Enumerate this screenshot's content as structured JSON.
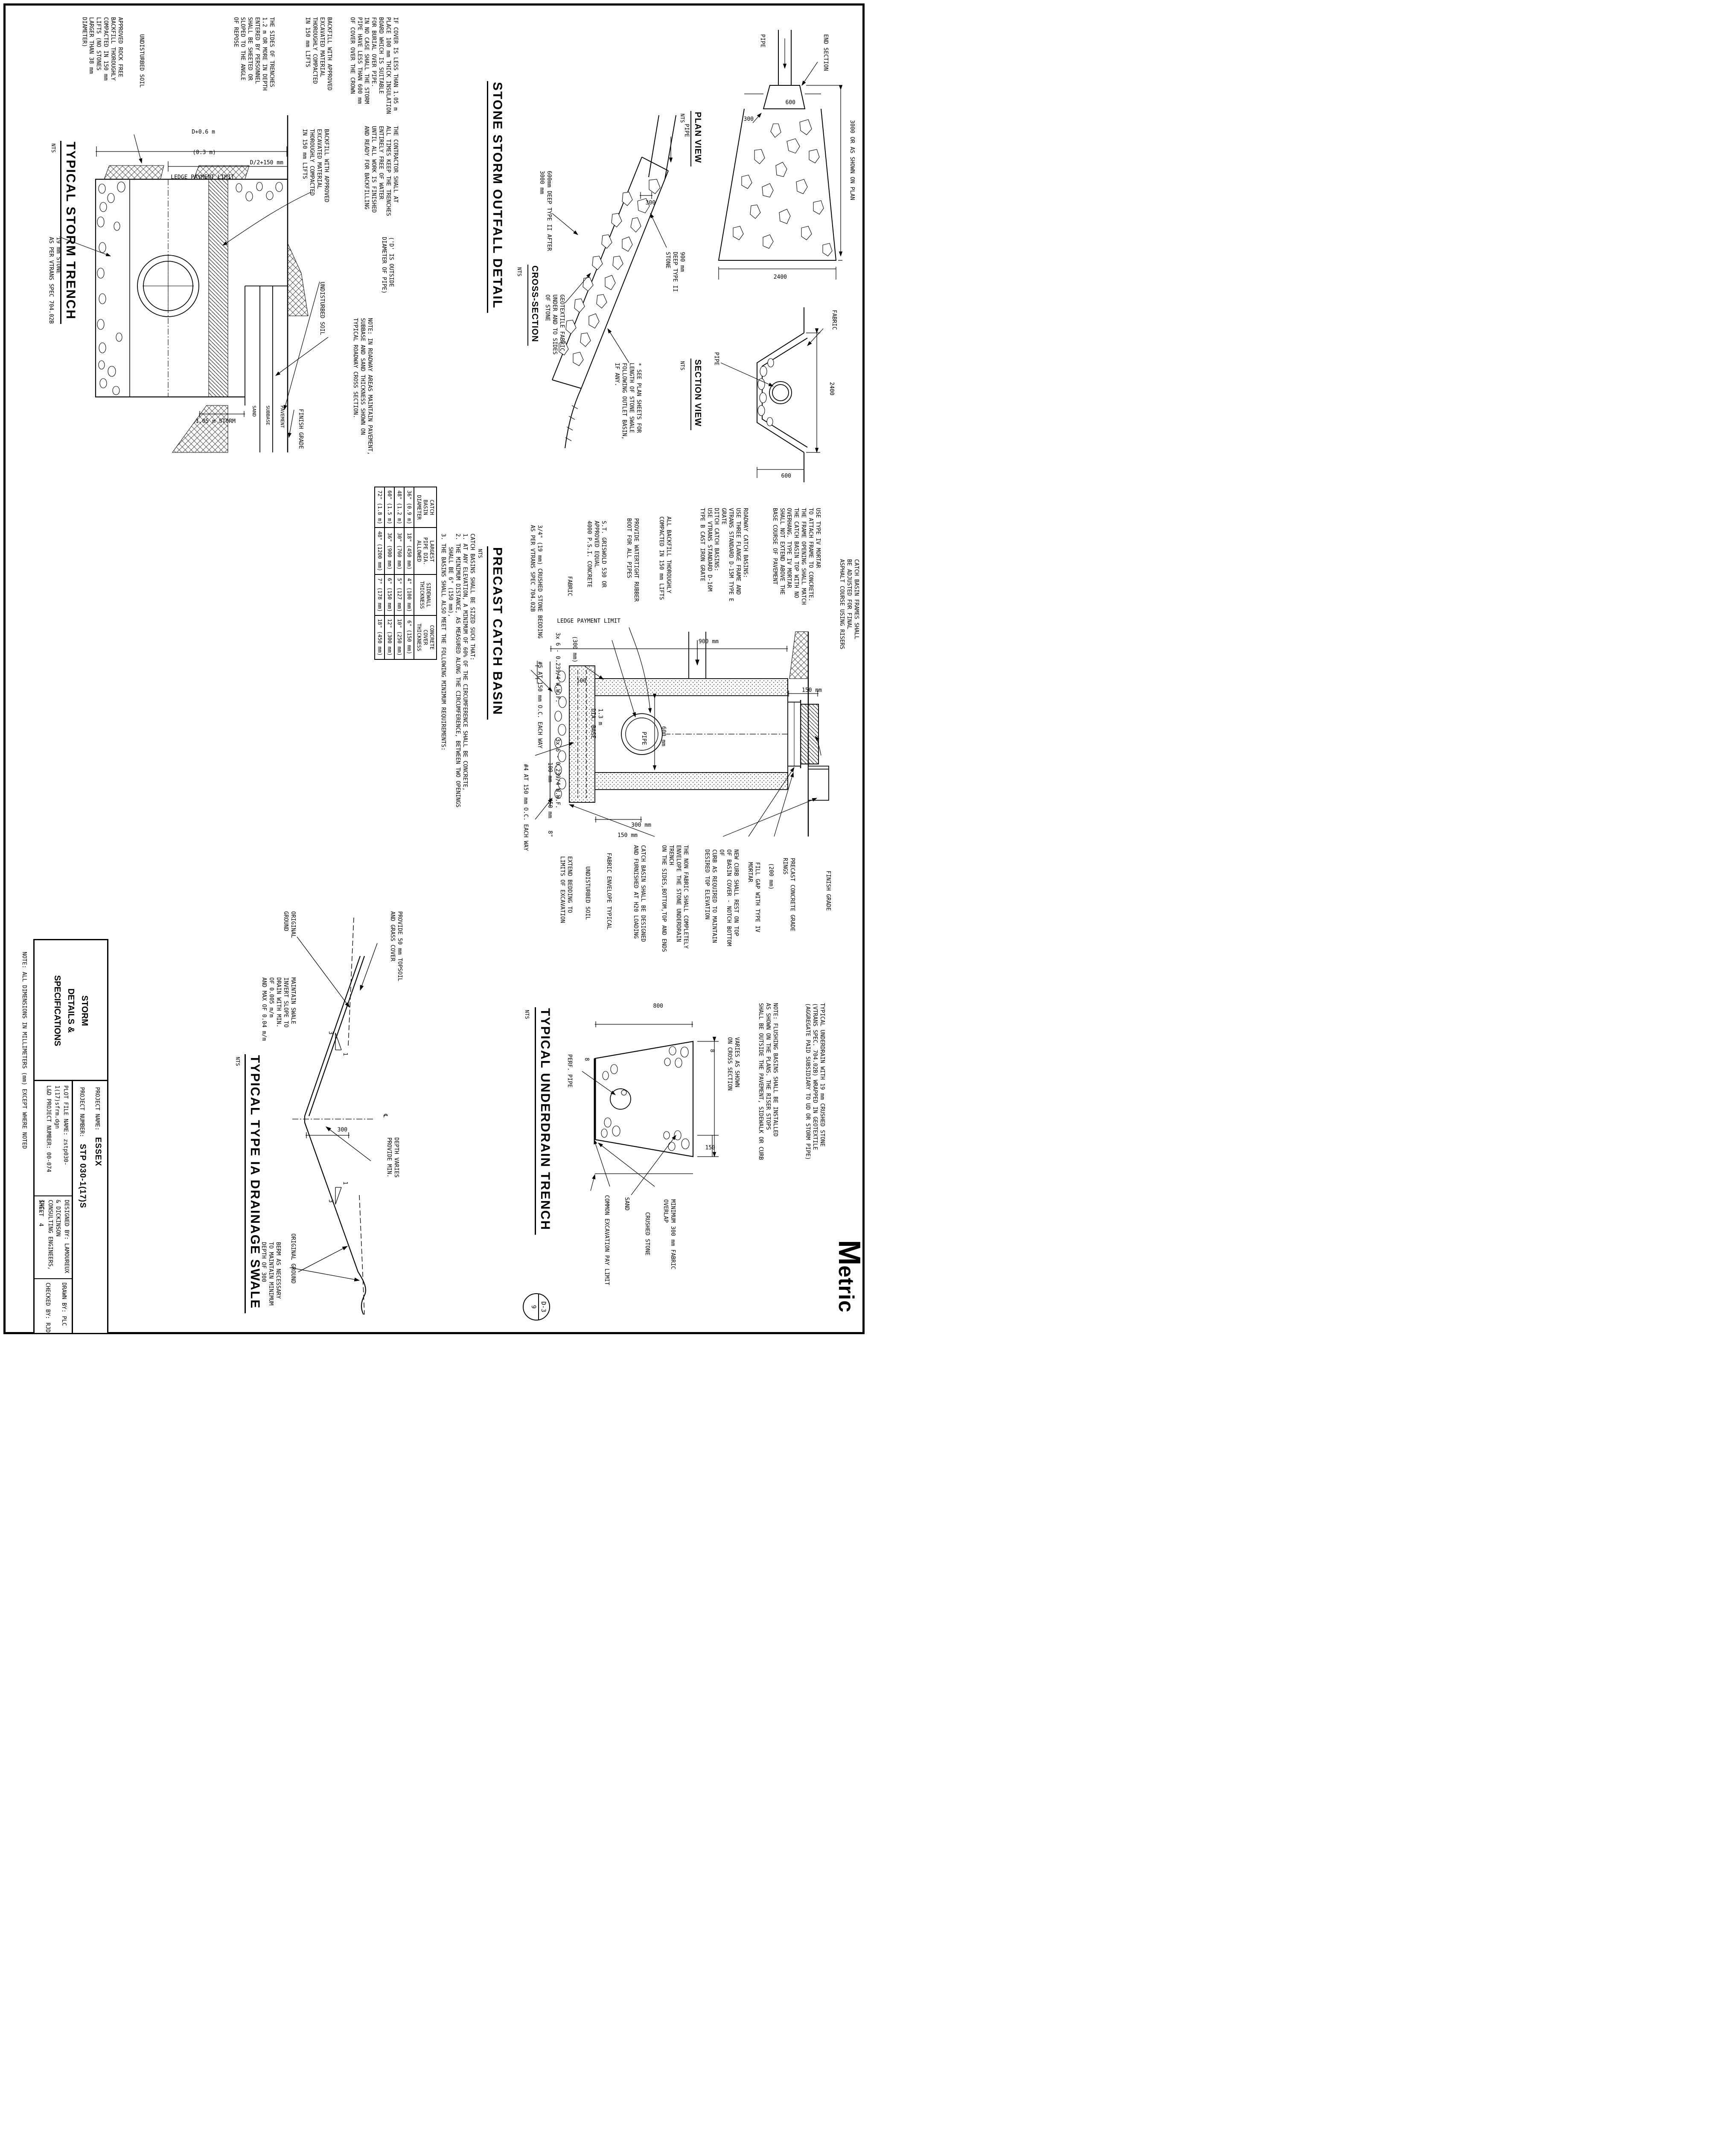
{
  "sheet": {
    "bottom_note": "NOTE: ALL DIMENSIONS IN MILLIMETERS (mm) EXCEPT WHERE NOTED",
    "logo_m": "M",
    "logo_rest": "etric",
    "nts": "NTS"
  },
  "title_block": {
    "discipline": "STORM\nDETAILS &\nSPECIFICATIONS",
    "project_name_label": "PROJECT NAME:",
    "project_name": "ESSEX",
    "project_number_label": "PROJECT NUMBER:",
    "project_number": "STP 030-1(17)S",
    "plot_file_label": "PLOT FILE NAME:",
    "plot_file": "zstp030-1(17)sfrm.dgn",
    "ld_project_label": "L&D PROJECT NUMBER:",
    "ld_project": "00-074",
    "designed_by_label": "DESIGNED BY:",
    "designed_by": "LAMOUREUX & DICKINSON",
    "firm": "CONSULTING ENGINEERS, INC.",
    "drawn_by_label": "DRAWN BY:",
    "drawn_by": "PLC",
    "checked_by_label": "CHECKED BY:",
    "checked_by": "RJD",
    "sheet_label": "SHEET",
    "sheet_number": "4"
  },
  "storm_trench": {
    "title": "TYPICAL STORM TRENCH",
    "dims": {
      "half_width": "D/2+150 mm",
      "offset": "(0.3 m)",
      "total_width": "D+0.6 m",
      "cover": "1.05 m STORM"
    },
    "labels": {
      "ledge": "LEDGE PAYMENT LIMIT",
      "finish_grade": "FINISH GRADE",
      "pavement": "PAVEMENT",
      "subbase": "SUBBASE",
      "sand": "SAND",
      "undisturbed_soil": "UNDISTURBED SOIL",
      "undisturbed_soil_2": "UNDISTURBED SOIL",
      "stone": "19 mm STONE\nAS PER VTRANS SPEC 704.02B"
    },
    "notes": {
      "insulation": "IF COVER IS LESS THAN 1.05 m\nPLACE 100 mm THICK INSULATION\nBOARD WHICH IS SUITABLE\nFOR BURIAL OVER PIPE.\nIN NO CASE SHALL THE STORM\nPIPE HAVE LESS THAN 600 mm\nOF COVER OVER THE CROWN",
      "contractor": "THE CONTRACTOR SHALL AT\nALL TIMES KEEP THE TRENCHES\nENTIRELY FREE OF WATER\nUNTIL ALL WORK IS FINISHED\nAND READY FOR BACKFILLING",
      "d_note": "('D' IS OUTSIDE\nDIAMETER OF PIPE)",
      "roadway": "NOTE: IN ROADWAY AREAS MAINTAIN PAVEMENT,\nSUBBASE AND SAND THICKNESS SHOWN ON\nTYPICAL ROADWAY CROSS SECTION.",
      "backfill_approved": "BACKFILL WITH APPROVED\nEXCAVATED MATERIAL\nTHOROUGHLY COMPACTED\nIN 150 mm LIFTS",
      "backfill_approved_2": "BACKFILL WITH APPROVED\nEXCAVATED MATERIAL\nTHOROUGHLY COMPACTED\nIN 150 mm LIFTS",
      "sides": "THE SIDES OF TRENCHES\n1.2 m OR MORE IN DEPTH\nENTERED BY PERSONNEL\nSHALL BE SHEETED OR\nSLOPED TO THE ANGLE\nOF REPOSE",
      "rock_free": "APPROVED ROCK FREE\nBACKFILL THOROUGHLY\nCOMPACTED IN 150 mm\nLIFTS (NO STONES\nLARGER THAN 38 mm\nDIAMETER)"
    }
  },
  "outfall": {
    "title": "STONE STORM OUTFALL DETAIL",
    "cross_section": {
      "subtitle": "CROSS-SECTION",
      "pipe": "PIPE",
      "dim_300": "300",
      "stone_depth": "900 mm\nDEEP TYPE II\nSTONE",
      "geotextile": "GEOTEXTILE FABRIC\nUNDER AND TO SIDES\nOF STONE",
      "after_note": "600mm DEEP TYPE II AFTER\n3000 mm",
      "see_plan": "* SEE PLAN SHEETS FOR\nLENGTH OF STONE SWALE\nFOLLOWING OUTLET BASIN,\nIF ANY."
    },
    "plan_view": {
      "subtitle": "PLAN VIEW",
      "dim_length": "3000 OR AS SHOWN ON PLAN",
      "end_section": "END SECTION",
      "pipe": "PIPE",
      "dim_300": "300",
      "dim_600": "600",
      "dim_2400": "2400"
    },
    "section_view": {
      "subtitle": "SECTION VIEW",
      "pipe": "PIPE",
      "fabric": "FABRIC",
      "dim_600": "600",
      "dim_2400": "2400"
    }
  },
  "catch_basin": {
    "title": "PRECAST CATCH BASIN",
    "sizing_notes": "CATCH BASINS SHALL BE SIZED SUCH THAT:\n1. AT ANY ELEVATION, A MINIMUM OF 60% OF THE CIRCUMFERENCE SHALL BE CONCRETE,\n2. THE MINIMUM DISTANCE, AS MEASURED ALONG THE CIRCUMFERENCE, BETWEEN TWO OPENINGS\n    SHALL BE 6\" (150 mm),\n3. THE BASINS SHALL ALSO MEET THE FOLLOWING MINIMUM REQUIREMENTS:",
    "table": {
      "headers": [
        "CATCH\nBASIN\nDIAMETER",
        "LARGEST\nPIPE DIA.\nALLOWED",
        "SIDEWALL\nTHICKNESS",
        "CONCRETE\nCOVER\nTHICKNESS"
      ],
      "rows": [
        [
          "36\" (0.9 m)",
          "18\" (450 mm)",
          "4\" (100 mm)",
          "6\" (150 mm)"
        ],
        [
          "48\" (1.2 m)",
          "30\" (760 mm)",
          "5\" (127 mm)",
          "10\" (250 mm)"
        ],
        [
          "60\" (1.5 m)",
          "36\" (900 mm)",
          "6\" (150 mm)",
          "12\" (300 mm)"
        ],
        [
          "72\" (1.8 m)",
          "48\" (1200 mm)",
          "7\" (178 mm)",
          "18\" (450 mm)"
        ]
      ]
    },
    "notes": {
      "frames": "CATCH BASIN FRAMES SHALL\nBE ADJUSTED FOR FINAL\nASPHALT COURSE USING RISERS",
      "mortar": "USE TYPE IV MORTAR\nTO ATTACH FRAME TO CONCRETE.\nTHE FRAME OPENING SHALL MATCH\nTHE CATCH BASIN TOP WITH NO\nOVERHANG. TYPE IV MORTAR\nSHALL NOT EXTEND ABOVE THE\nBASE COURSE OF PAVEMENT",
      "grates": "ROADWAY CATCH BASINS:\nUSE THREE FLANGE FRAME AND\nVTRANS STANDARD D-15M TYPE E GRATE\nDITCH CATCH BASINS:\nUSE VTRANS STANDARD D-16M\nTYPE B CAST IRON GRATE",
      "backfill": "ALL BACKFILL THOROUGHLY\nCOMPACTED IN 150 mm LIFTS",
      "boot": "PROVIDE WATERTIGHT RUBBER\nBOOT FOR ALL PIPES",
      "concrete": "S.T. GRISWOLD 530 OR\nAPPROVED EQUAL\n4000 P.S.I. CONCRETE",
      "fabric": "FABRIC",
      "ledge": "LEDGE PAYMENT LIMIT",
      "bedding": "3/4\" (19 mm) CRUSHED STONE BEDDING\nAS PER VTRANS SPEC 704.02B",
      "extend": "EXTEND BEDDING TO\nLIMITS OF EXCAVATION",
      "soil": "UNDISTURBED SOIL",
      "envelope": "FABRIC ENVELOPE TYPICAL",
      "h20": "CATCH BASIN SHALL BE DESIGNED\nAND FURNISHED AT H20 LOADING",
      "wwf1": "3x 6 - 0.239/4 W.W.F.",
      "wwf2": "3x 6 - 0.239/4 W.W.F.",
      "rebar5": "#5 AT 150 mm O.C. EACH WAY",
      "rebar4": "#4 AT 150 mm O.C. EACH WAY",
      "rings": "PRECAST CONCRETE GRADE RINGS",
      "fill_gap": "FILL GAP WITH TYPE IV MORTAR",
      "curb": "NEW CURB SHALL REST ON TOP\nOF BASIN COVER - NOTCH BOTTOM OF\nCURB AS REQUIRED TO MAINTAIN\nDESIRED TOP ELEVATION",
      "non_fabric": "THE NON FABRIC SHALL COMPLETELY\nENVELOPE THE STONE UNDERDRAIN TRENCH\nON THE SIDES,BOTTOM,TOP AND ENDS",
      "finish_grade": "FINISH GRADE",
      "pipe": "PIPE",
      "base": "1.3 m\nDIA. BASE"
    },
    "dims": {
      "d150": "150 mm",
      "d900": "900 mm",
      "d600": "600 mm",
      "d300p": "(300 mm)",
      "d100": "100",
      "d200p": "(200 mm)",
      "d100mm": "100 mm",
      "d450": "450 mm",
      "d8": "8\"",
      "d300": "300 mm",
      "d150b": "150 mm"
    }
  },
  "swale": {
    "title": "TYPICAL TYPE IA DRAINAGE SWALE",
    "labels": {
      "topsoil": "PROVIDE 50 mm TOPSOIL\nAND GRASS COVER",
      "original_ground": "ORIGINAL\nGROUND",
      "original_ground_2": "ORIGINAL GROUND",
      "invert": "MAINTAIN SWALE\nINVERT SLOPE TO\nDRAIN WITH MIN.\nOF 0.005 m/m\nAND MAX OF 0.04 m/m",
      "depth": "DEPTH VARIES\nPROVIDE MIN.",
      "berm": "BERM AS NECESSARY\nTO MAINTAIN MINIMUM\nDEPTH OF 300",
      "centerline": "℄",
      "slope_h": "3",
      "slope_v": "1",
      "dim_300": "300"
    }
  },
  "underdrain": {
    "title": "TYPICAL UNDERDRAIN TRENCH",
    "labels": {
      "varies": "VARIES AS SHOWN\nON CROSS SECTION",
      "overlap": "MINIMUM 300 mm FABRIC OVERLAP",
      "crushed": "CRUSHED STONE",
      "sand": "SAND",
      "pay_limit": "COMMON EXCAVATION PAY LIMIT",
      "perf": "PERF. PIPE",
      "dim_150": "150",
      "dim_800": "800",
      "dim_8a": "8",
      "dim_8b": "8",
      "bubble_top": "D-3",
      "bubble_bottom": "9"
    },
    "notes": {
      "typical": "TYPICAL UNDERDRAIN WITH 19 mm CRUSHED STONE\n(VTRANS SPEC. 704.02B) WRAPPED IN GEOTEXTILE\n(AGGREGATE PAID SUBSIDIARY TO UD OR STORM PIPE)",
      "flushing": "NOTE: FLUSHING BASINS SHALL BE INSTALLED\nAS SHOWN ON THE PLANS. THE RISER STOPS\nSHALL BE OUTSIDE THE PAVEMENT, SIDEWALK OR CURB"
    }
  }
}
